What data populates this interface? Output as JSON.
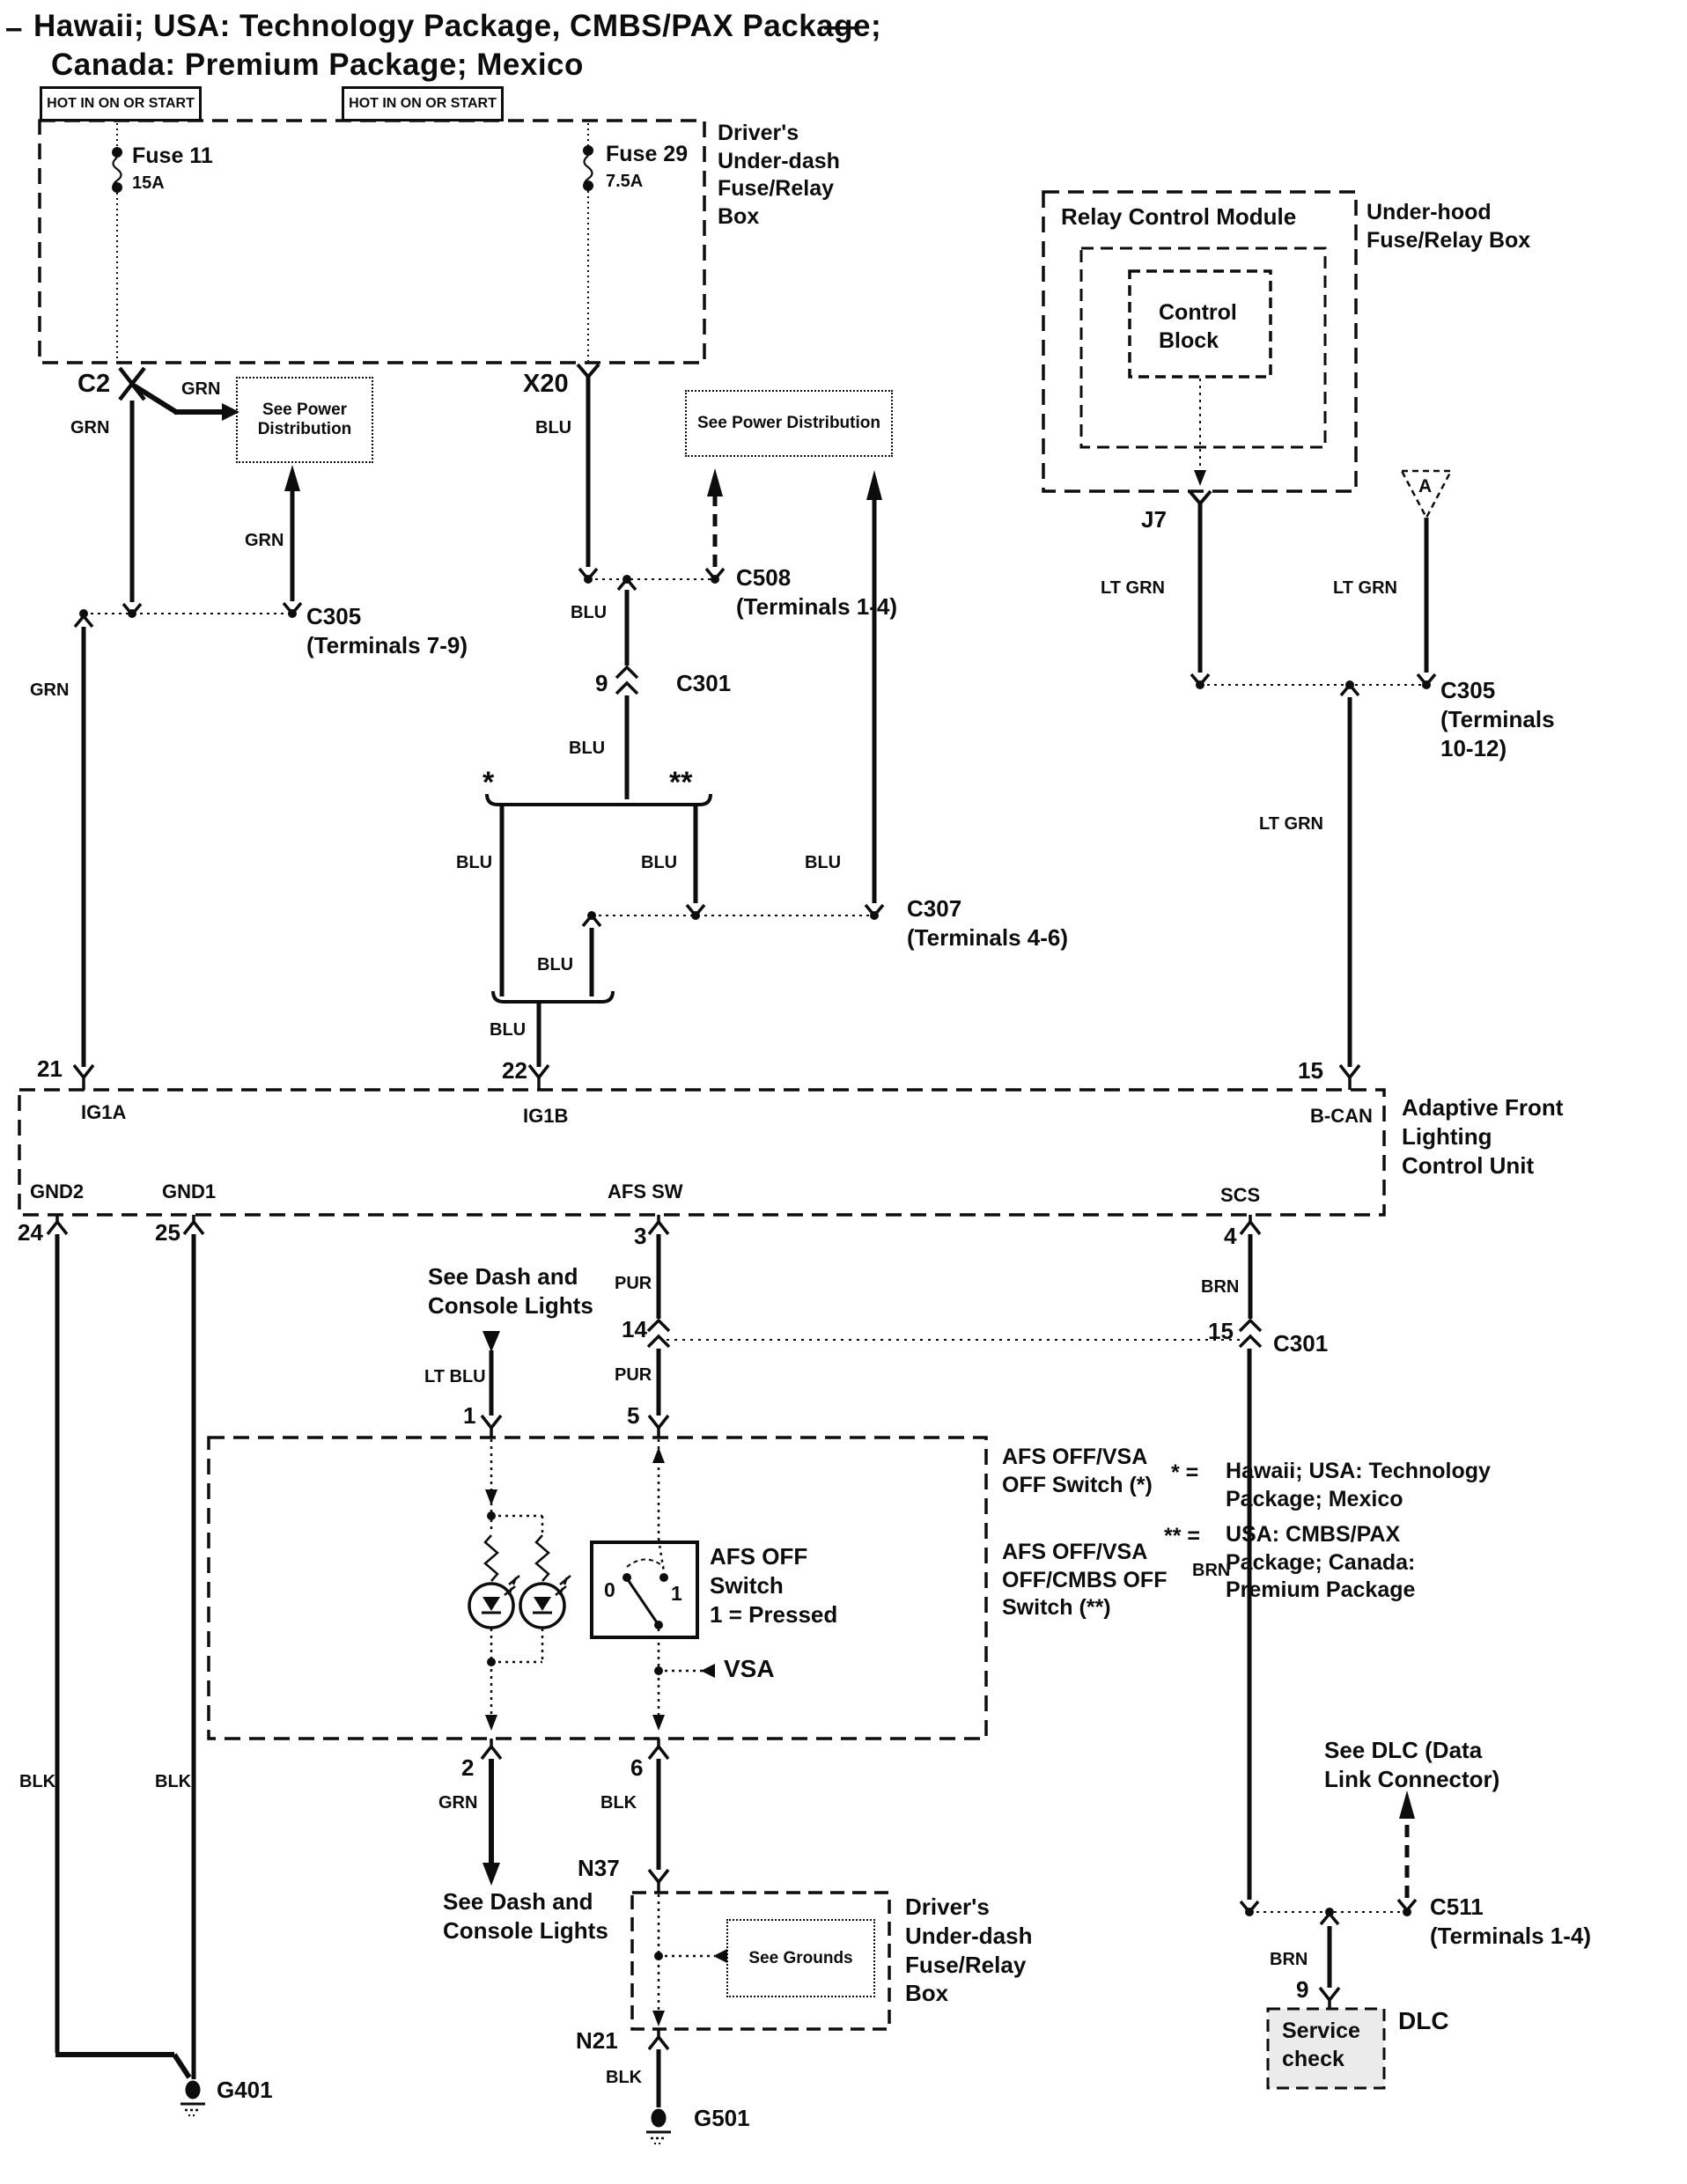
{
  "title": {
    "dash_left": "–",
    "line1": "Hawaii; USA: Technology Package, CMBS/PAX Package;",
    "dash_right": "—",
    "line2": "Canada: Premium Package; Mexico"
  },
  "labels": {
    "hot1": "HOT IN ON OR START",
    "hot2": "HOT IN ON OR START",
    "fuse11": "Fuse 11",
    "fuse11_amp": "15A",
    "fuse29": "Fuse 29",
    "fuse29_amp": "7.5A",
    "underdash_box_top": "Driver's\nUnder-dash\nFuse/Relay\nBox",
    "c2": "C2",
    "x20": "X20",
    "grn_branch": "GRN",
    "grn_c2": "GRN",
    "blu_x20": "BLU",
    "see_power_1": "See Power\nDistribution",
    "see_power_2": "See Power Distribution",
    "grn_up": "GRN",
    "c305_a": "C305\n(Terminals 7-9)",
    "c508": "C508\n(Terminals 1-4)",
    "grn_left": "GRN",
    "blu_seg1": "BLU",
    "pin9": "9",
    "c301_a": "C301",
    "blu_seg2": "BLU",
    "star": "*",
    "dblstar": "**",
    "blu_branch_l": "BLU",
    "blu_branch_r": "BLU",
    "blu_branch_up": "BLU",
    "c307": "C307\n(Terminals 4-6)",
    "blu_mid": "BLU",
    "blu_low": "BLU",
    "relay_module": "Relay Control Module",
    "control_block": "Control\nBlock",
    "underhood_box": "Under-hood\nFuse/Relay Box",
    "a_conn": "A",
    "j7": "J7",
    "ltgrn_j7": "LT GRN",
    "ltgrn_a": "LT GRN",
    "ltgrn_bcan": "LT GRN",
    "c305_b": "C305\n(Terminals\n10-12)",
    "pin21": "21",
    "pin22": "22",
    "pin15_top": "15",
    "ig1a": "IG1A",
    "ig1b": "IG1B",
    "bcan": "B-CAN",
    "unit_name": "Adaptive Front\nLighting\nControl Unit",
    "gnd2": "GND2",
    "gnd1": "GND1",
    "afs_sw": "AFS SW",
    "scs": "SCS",
    "pin24": "24",
    "pin25": "25",
    "pin3": "3",
    "pin4": "4",
    "see_dash_top": "See Dash and\nConsole Lights",
    "pur1": "PUR",
    "brn1": "BRN",
    "pin14": "14",
    "pin15_mid": "15",
    "c301_b": "C301",
    "ltblu": "LT BLU",
    "pur2": "PUR",
    "pin1": "1",
    "pin5": "5",
    "switch_note_1": "AFS OFF/VSA\nOFF Switch (*)",
    "switch_note_2": "AFS OFF/VSA\nOFF/CMBS OFF\nSwitch (**)",
    "legend_star": "*  =",
    "legend_star_text": "Hawaii; USA: Technology\nPackage; Mexico",
    "legend_dbl": "** =",
    "legend_dbl_text": "USA: CMBS/PAX\nPackage; Canada:\nPremium Package",
    "afs_off_switch": "AFS OFF\nSwitch\n1 = Pressed",
    "sw_0": "0",
    "sw_1": "1",
    "vsa": "VSA",
    "pin2": "2",
    "pin6": "6",
    "grn_pin2": "GRN",
    "blk_pin6": "BLK",
    "blk_24": "BLK",
    "blk_25": "BLK",
    "brn_long": "BRN",
    "see_dash_bottom": "See Dash and\nConsole Lights",
    "n37": "N37",
    "see_grounds": "See Grounds",
    "underdash_box_bottom": "Driver's\nUnder-dash\nFuse/Relay\nBox",
    "n21": "N21",
    "blk_n21": "BLK",
    "g401": "G401",
    "g501": "G501",
    "see_dlc": "See DLC (Data\nLink Connector)",
    "c511": "C511\n(Terminals 1-4)",
    "brn_dlc": "BRN",
    "pin9_dlc": "9",
    "service_check": "Service\ncheck",
    "dlc": "DLC"
  }
}
